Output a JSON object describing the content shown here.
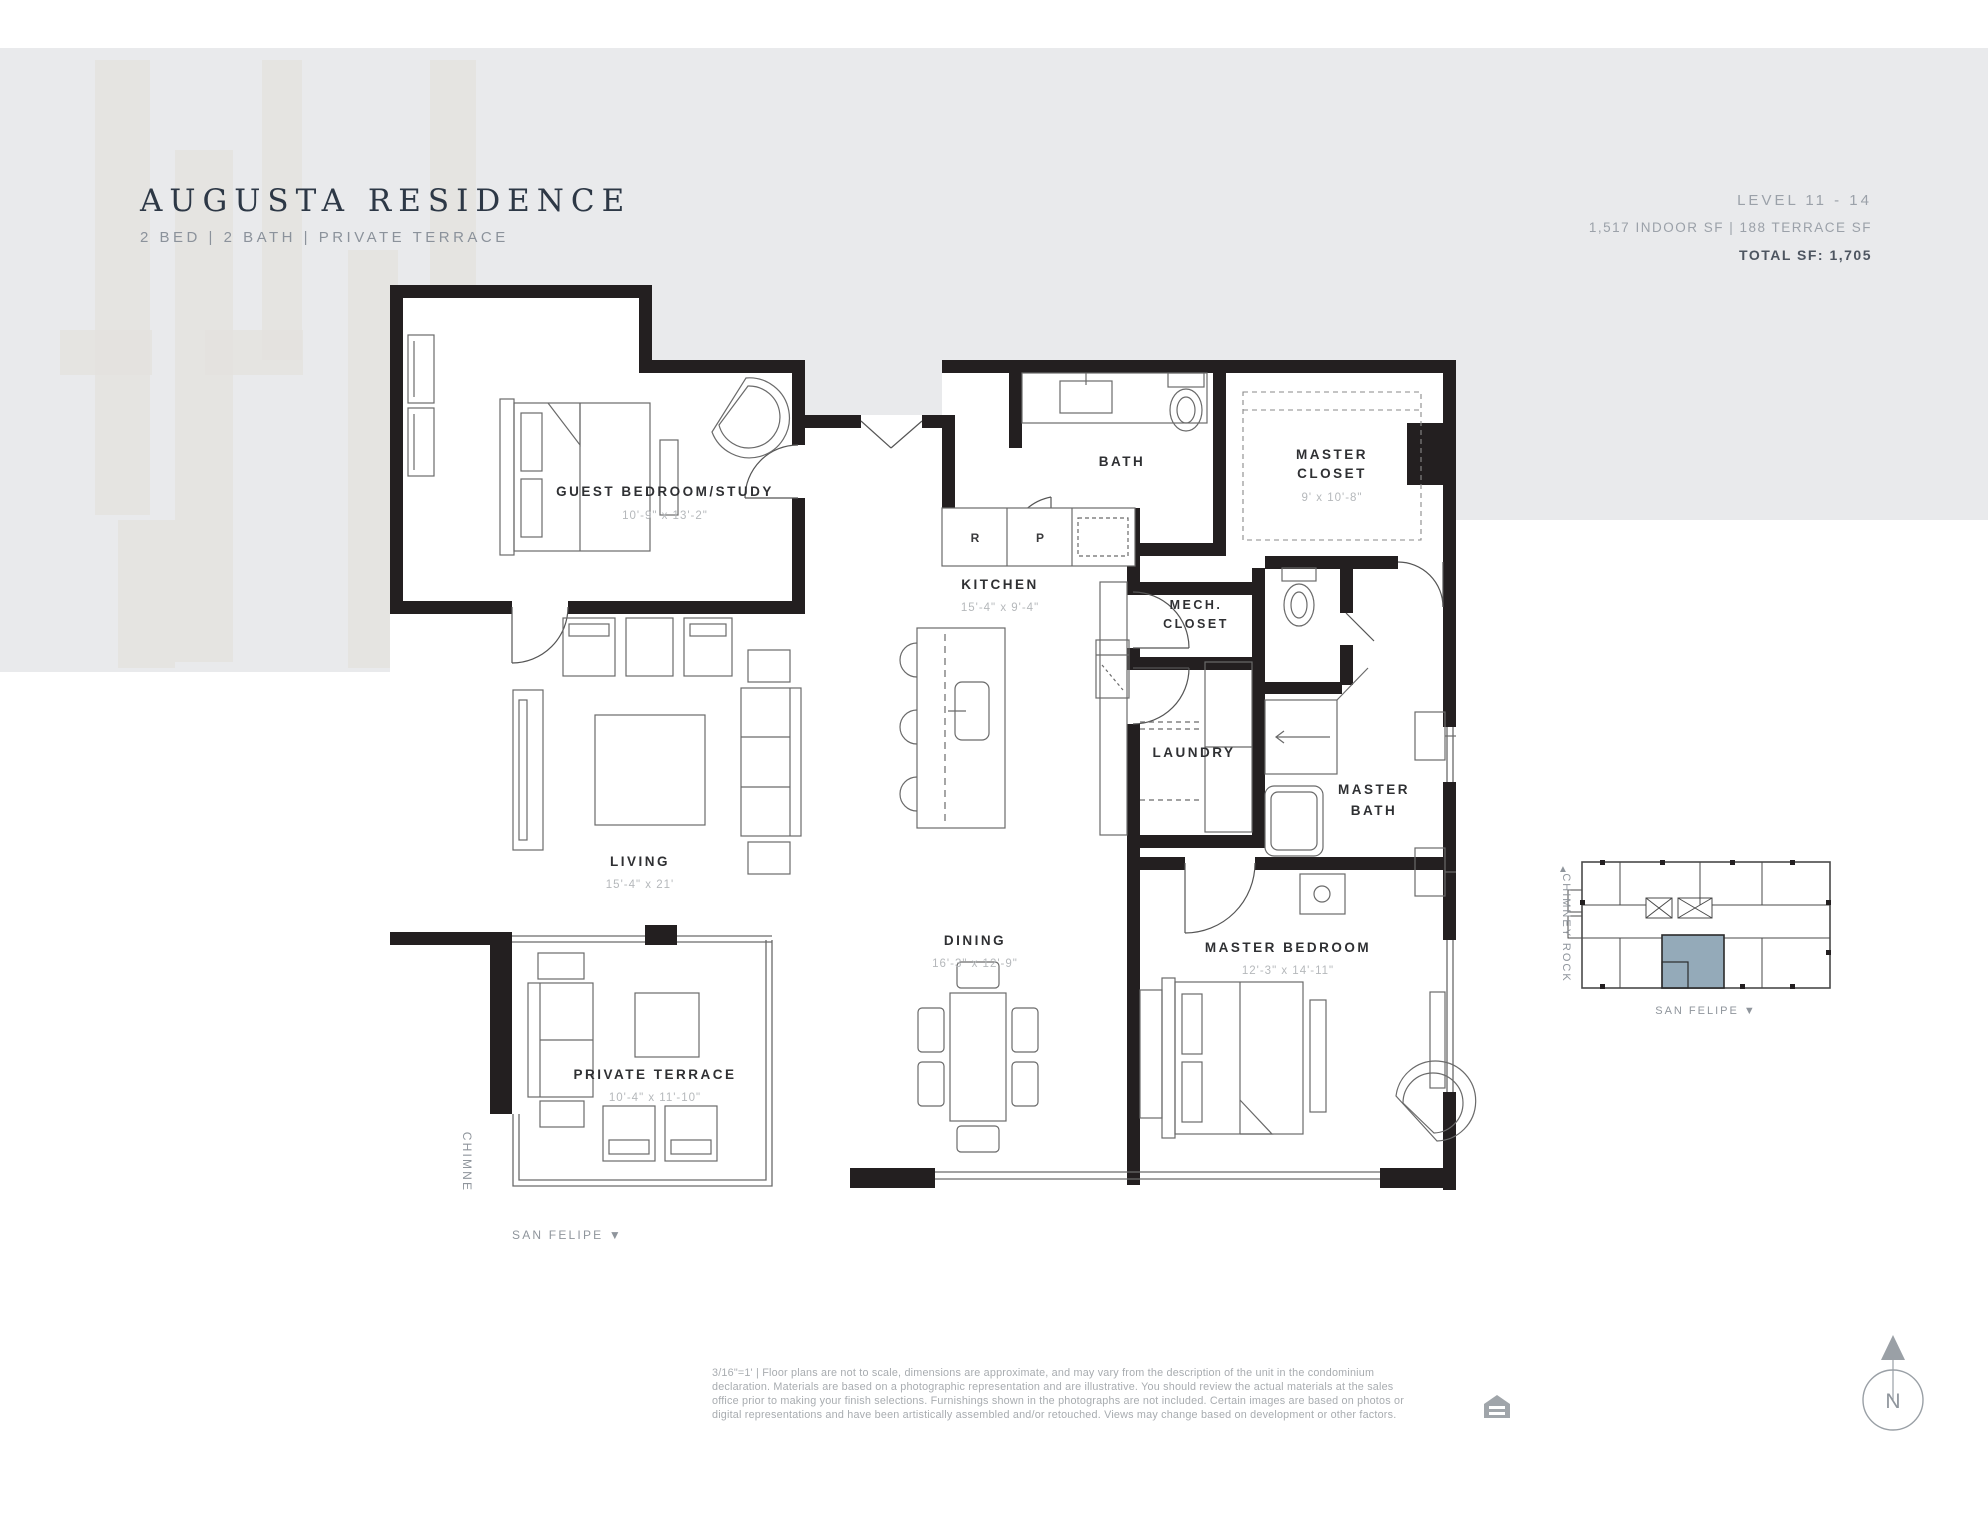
{
  "header": {
    "title": "AUGUSTA RESIDENCE",
    "subtitle": "2 BED  |  2 BATH  |  PRIVATE TERRACE",
    "level": "LEVEL 11 - 14",
    "area": "1,517 INDOOR SF   |   188 TERRACE SF",
    "total": "TOTAL SF:  1,705"
  },
  "rooms": {
    "guest_bedroom": {
      "name": "GUEST BEDROOM/STUDY",
      "dims": "10'-9\" x 13'-2\""
    },
    "kitchen": {
      "name": "KITCHEN",
      "dims": "15'-4\" x 9'-4\""
    },
    "bath": {
      "name": "BATH"
    },
    "master_closet": {
      "name_line1": "MASTER",
      "name_line2": "CLOSET",
      "dims": "9' x 10'-8\""
    },
    "mech_closet": {
      "name_line1": "MECH.",
      "name_line2": "CLOSET"
    },
    "laundry": {
      "name": "LAUNDRY"
    },
    "master_bath": {
      "name_line1": "MASTER",
      "name_line2": "BATH"
    },
    "living": {
      "name": "LIVING",
      "dims": "15'-4\" x 21'"
    },
    "dining": {
      "name": "DINING",
      "dims": "16'-3\" x 12'-9\""
    },
    "master_bedroom": {
      "name": "MASTER BEDROOM",
      "dims": "12'-3\" x 14'-11\""
    },
    "private_terrace": {
      "name": "PRIVATE TERRACE",
      "dims": "10'-4\" x 11'-10\""
    }
  },
  "appliances": {
    "refrigerator": "R",
    "pantry": "P"
  },
  "streets": {
    "plan_side": "CHIMNE",
    "plan_bottom": "SAN FELIPE ▼",
    "keyplan_side": "CHIMNEY ROCK",
    "keyplan_side_arrow": "▲",
    "keyplan_bottom": "SAN FELIPE ▼"
  },
  "compass": {
    "north": "N"
  },
  "disclaimer": {
    "line1": "3/16\"=1'   |   Floor plans are not to scale, dimensions are approximate, and may vary from the description of the unit in the condominium",
    "line2": "declaration.  Materials are based on a photographic representation and are illustrative.  You should review the actual materials at the sales",
    "line3": "office prior to making your finish selections.  Furnishings shown in the photographs are not included.  Certain images are based on photos or",
    "line4": "digital representations and have been artistically assembled and/or retouched.  Views may change based on development or other factors."
  },
  "colors": {
    "band": "#e9eaec",
    "wall": "#231f20",
    "title_text": "#2d3846",
    "muted_text": "#9ba1a9",
    "dim_text": "#b5b8bb",
    "keyplan_highlight": "#94aab9"
  }
}
